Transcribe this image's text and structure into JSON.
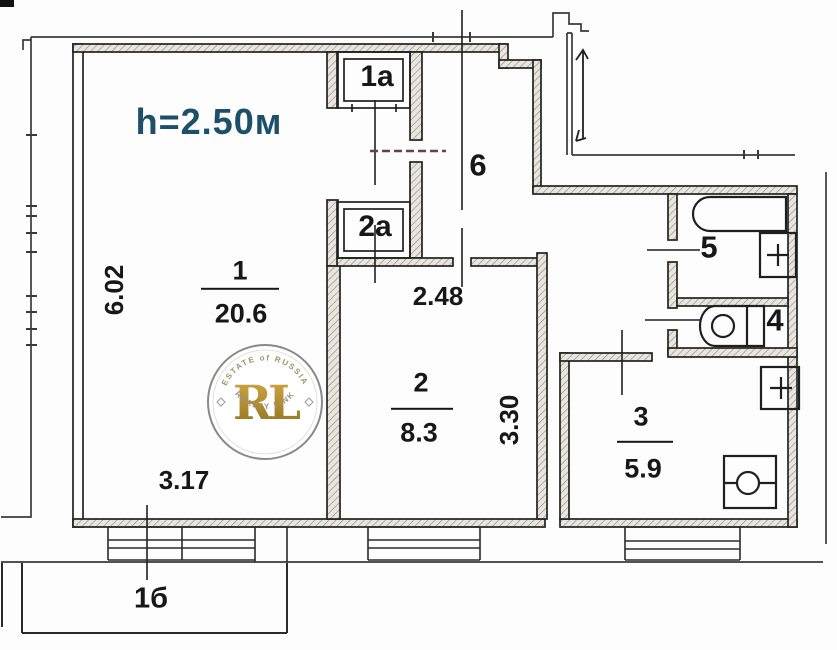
{
  "plan": {
    "height_note": "h=2.50м",
    "rooms": {
      "r1": {
        "num": "1",
        "area": "20.6"
      },
      "r2": {
        "num": "2",
        "area": "8.3"
      },
      "r3": {
        "num": "3",
        "area": "5.9"
      },
      "r4": {
        "num": "4"
      },
      "r5": {
        "num": "5"
      },
      "r6": {
        "num": "6"
      },
      "c1a": {
        "num": "1a"
      },
      "c2a": {
        "num": "2a"
      },
      "balcony": {
        "num": "1б"
      }
    },
    "dimensions": {
      "d602": "6.02",
      "d317": "3.17",
      "d248": "2.48",
      "d330": "3.30"
    },
    "colors": {
      "height_note": "#1b4f6a",
      "door_dash": "#6d4141",
      "watermark_gold": "#b6952e",
      "line": "#1f1f1f"
    }
  },
  "watermark": {
    "monogram": "RL",
    "arc_top": "ESTATE of RUSSIA",
    "arc_bottom": "REALTY LINK"
  }
}
